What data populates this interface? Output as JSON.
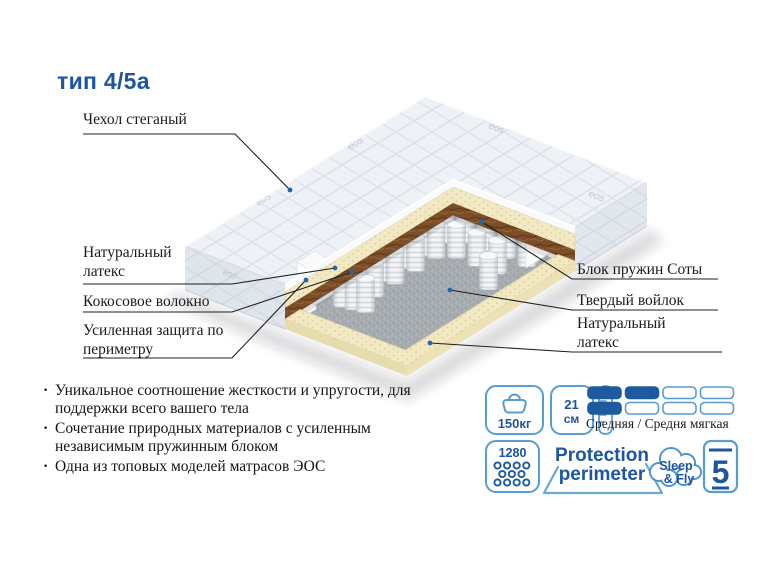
{
  "title": "тип 4/5а",
  "diagram": {
    "brand_mark": "eos",
    "labels_left": [
      {
        "text": "Чехол стеганый"
      },
      {
        "text": "Натуральный латекс"
      },
      {
        "text": "Кокосовое волокно"
      },
      {
        "text": "Усиленная защита по периметру"
      }
    ],
    "labels_right": [
      {
        "text": "Блок пружин Соты"
      },
      {
        "text": "Твердый войлок"
      },
      {
        "text": "Натуральный латекс"
      }
    ]
  },
  "features": [
    {
      "text": "Уникальное соотношение жесткости и упругости, для поддержки всего вашего тела"
    },
    {
      "text": "Сочетание природных материалов с усиленным независимым пружинным блоком"
    },
    {
      "text": "Одна из топовых моделей матрасов ЭОС"
    }
  ],
  "badges": {
    "max_weight": {
      "value": "150кг"
    },
    "height": {
      "value": "21",
      "unit": "см"
    },
    "firmness": {
      "label": "Средняя / Средня мягкая",
      "scale": [
        [
          1,
          1,
          0,
          0
        ],
        [
          1,
          0,
          0,
          0
        ]
      ]
    },
    "springs": {
      "count": "1280"
    },
    "protection": {
      "line1": "Protection",
      "line2": "perimeter"
    },
    "brand": {
      "line1": "Sleep",
      "line2": "& Fly"
    },
    "warranty": {
      "value": "5"
    }
  },
  "colors": {
    "accent": "#1d55a0",
    "accent_light": "#569dd4",
    "bar_fill": "#1d5b9e",
    "text": "#1b1b1b"
  }
}
